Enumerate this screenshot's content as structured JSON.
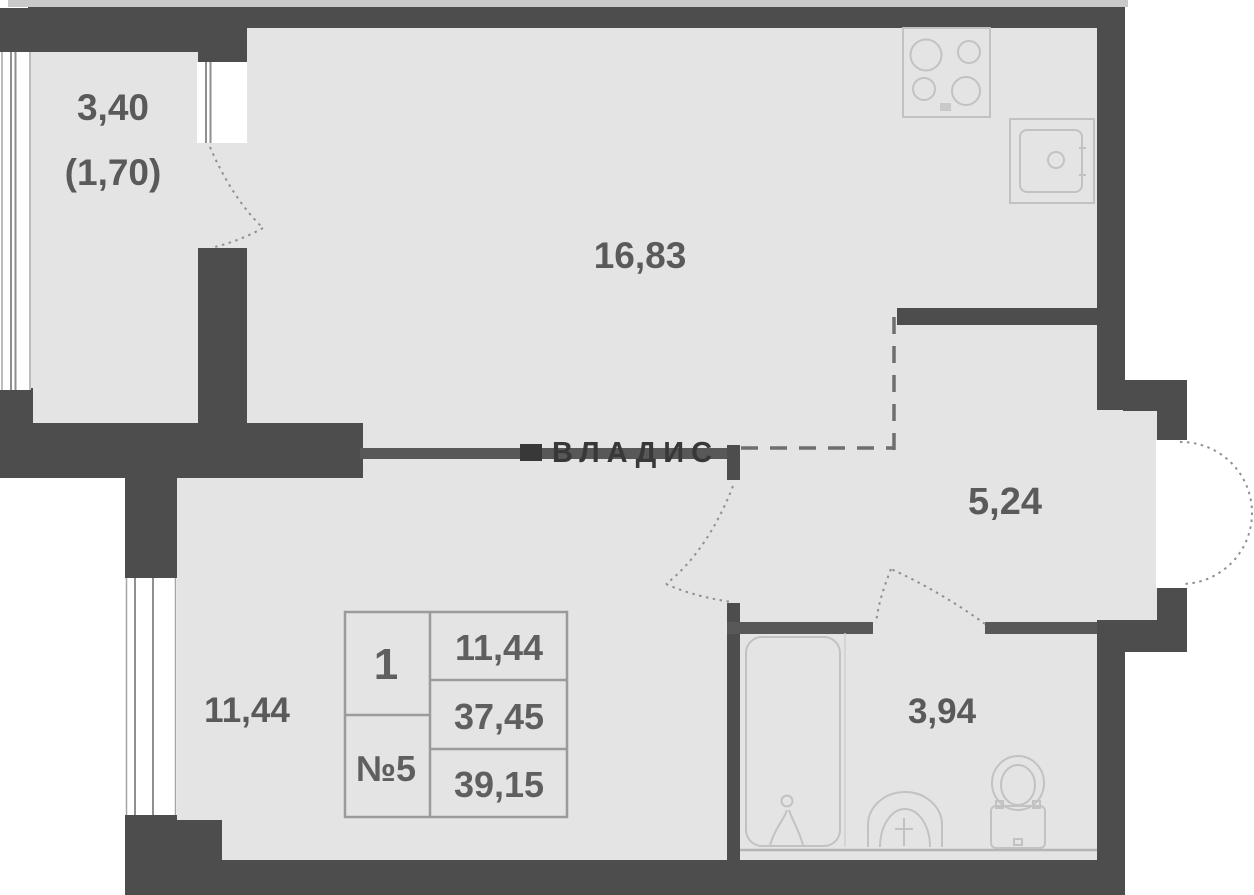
{
  "watermark": {
    "label": "ВЛАДИС"
  },
  "rooms": {
    "balcony": {
      "area": "3,40",
      "area_reduced": "(1,70)"
    },
    "kitchen_living": {
      "area": "16,83"
    },
    "hallway": {
      "area": "5,24"
    },
    "bedroom": {
      "area": "11,44"
    },
    "bathroom": {
      "area": "3,94"
    }
  },
  "info_table": {
    "rooms_count": "1",
    "unit_number": "№5",
    "living_area": "11,44",
    "area_without_summer": "37,45",
    "total_area": "39,15"
  },
  "fixtures": [
    "stove-icon",
    "kitchen-sink-icon",
    "bathtub-icon",
    "washbasin-icon",
    "toilet-icon"
  ],
  "colors": {
    "wall": "#4d4d4d",
    "floor": "#e4e4e4",
    "background": "#ffffff",
    "fixture_outline": "#c2c2c2",
    "label_text": "#5a5a5a",
    "table_border": "#9b9b9b",
    "watermark_text": "#383838"
  }
}
